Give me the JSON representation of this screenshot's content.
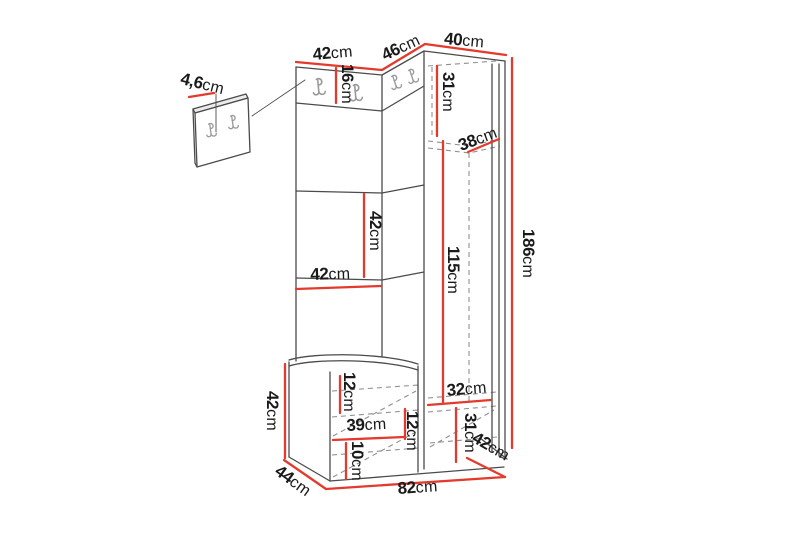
{
  "diagram": {
    "type": "furniture-dimension-drawing",
    "unit": "cm",
    "colors": {
      "dimension_line": "#e23b2e",
      "outline": "#4b4b4b",
      "hidden_line": "#909090",
      "hook": "#9b9b9b",
      "label_text": "#1a1a1a",
      "panel_shade": "#ececec",
      "face_fill": "#ffffff",
      "background": "#ffffff"
    },
    "dimensions": {
      "top_left_width": {
        "value": "42",
        "unit": "cm"
      },
      "top_corner_width": {
        "value": "46",
        "unit": "cm"
      },
      "top_right_width": {
        "value": "40",
        "unit": "cm"
      },
      "panel_thickness": {
        "value": "4,6",
        "unit": "cm"
      },
      "hook_panel_height": {
        "value": "16",
        "unit": "cm"
      },
      "wardrobe_top_section_height": {
        "value": "31",
        "unit": "cm"
      },
      "wardrobe_shelf_width": {
        "value": "38",
        "unit": "cm"
      },
      "shelf_section_height": {
        "value": "42",
        "unit": "cm"
      },
      "shelf_section_width": {
        "value": "42",
        "unit": "cm"
      },
      "wardrobe_inner_height": {
        "value": "115",
        "unit": "cm"
      },
      "total_height": {
        "value": "186",
        "unit": "cm"
      },
      "bench_height": {
        "value": "42",
        "unit": "cm"
      },
      "bench_top_section_height": {
        "value": "12",
        "unit": "cm"
      },
      "bench_inner_width": {
        "value": "39",
        "unit": "cm"
      },
      "bench_middle_section_height": {
        "value": "12",
        "unit": "cm"
      },
      "bench_bottom_section_height": {
        "value": "10",
        "unit": "cm"
      },
      "wardrobe_bottom_width": {
        "value": "32",
        "unit": "cm"
      },
      "wardrobe_bottom_section_height": {
        "value": "31",
        "unit": "cm"
      },
      "wardrobe_depth": {
        "value": "42",
        "unit": "cm"
      },
      "bench_depth": {
        "value": "44",
        "unit": "cm"
      },
      "total_width": {
        "value": "82",
        "unit": "cm"
      }
    }
  }
}
